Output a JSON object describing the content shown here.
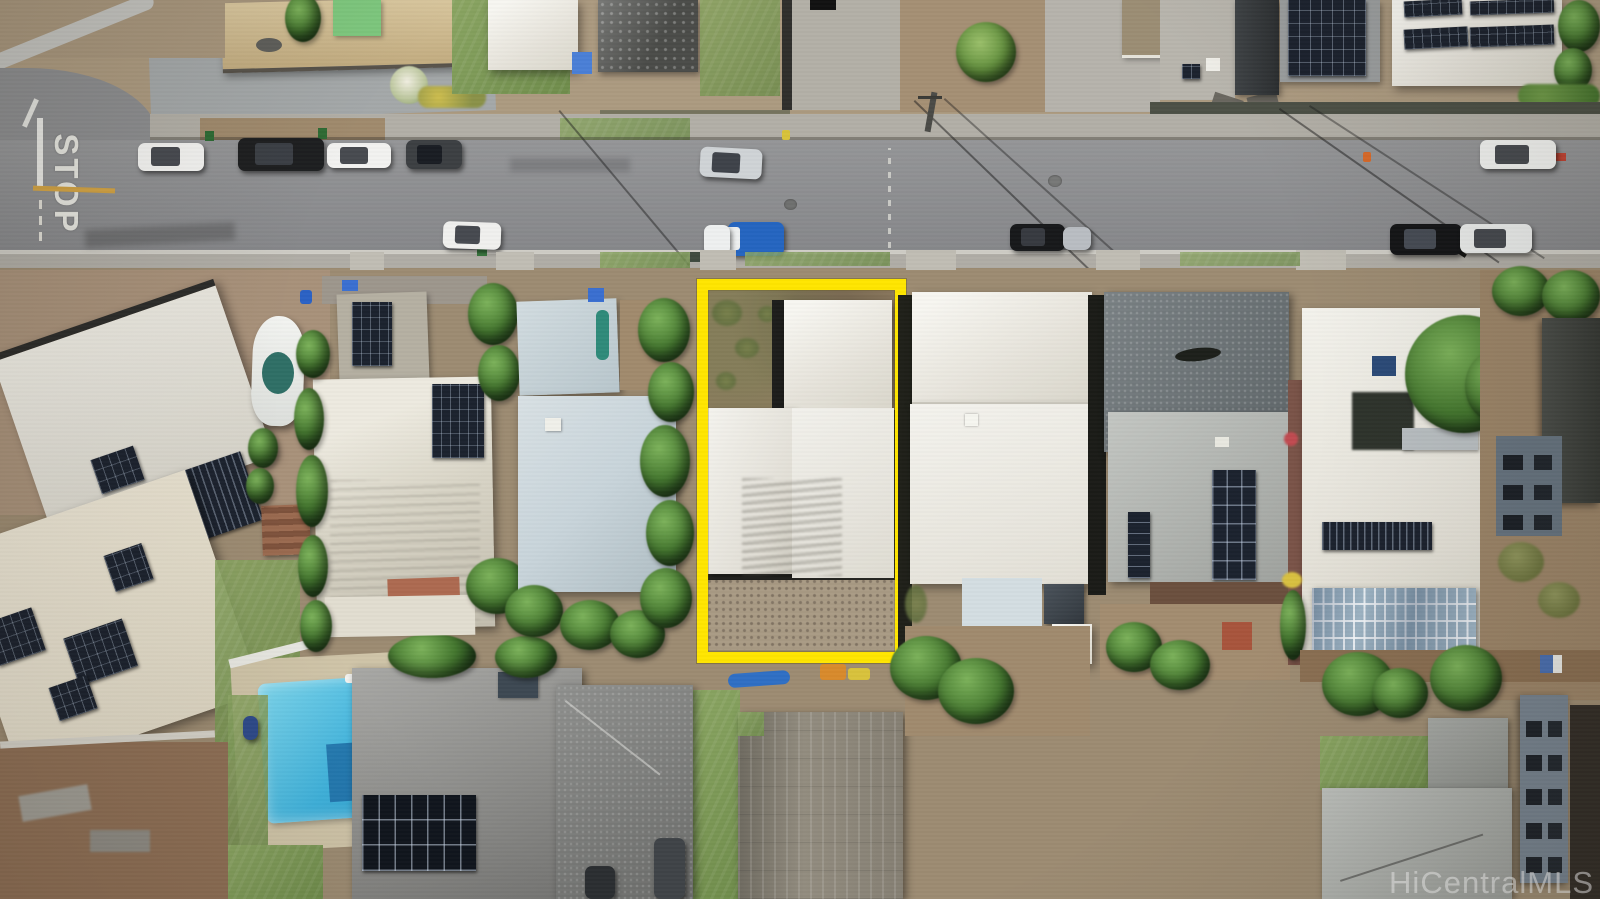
{
  "image": {
    "type": "aerial-drone-photograph",
    "subject": "residential-neighborhood-with-highlighted-property-lot",
    "watermark_text": "HiCentralMLS",
    "road_marking_text": "STOP"
  },
  "colors": {
    "lot_outline": "#ffe600",
    "road_asphalt": "#8c8d8f",
    "sidewalk_concrete": "#b5b2aa",
    "dirt_ground": "#a38c70",
    "grass_green": "#7f9a58",
    "tree_green": "#44772f",
    "pool_water": "#3fb3dd",
    "white_roof": "#f2f1ea",
    "metal_roof_bluegray": "#c8d4da",
    "solar_panel_dark": "#1b222e",
    "stop_marking_white": "#e6e6e0",
    "center_line_yellow": "#d2a344"
  }
}
